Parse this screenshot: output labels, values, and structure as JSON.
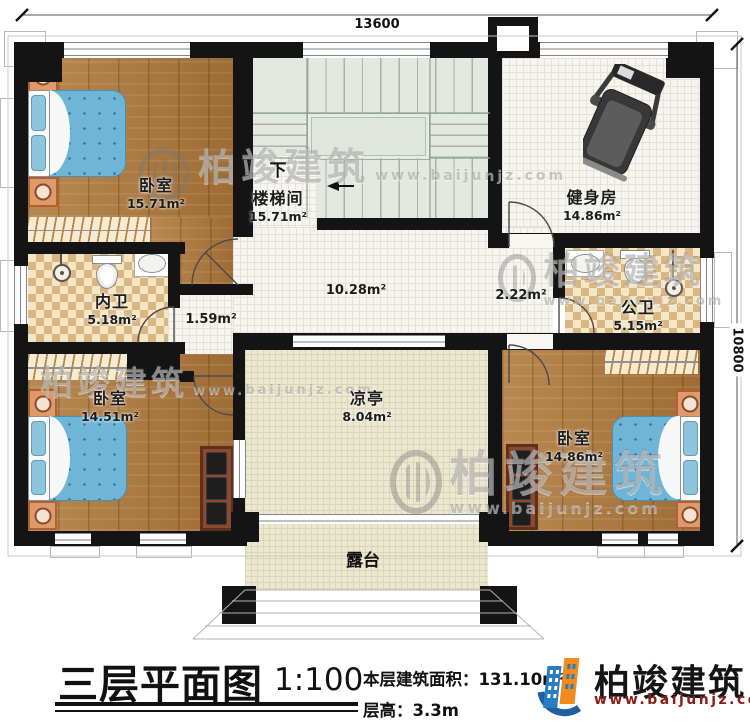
{
  "dimensions": {
    "top": "13600",
    "right": "10800"
  },
  "rooms": {
    "bedroom_tl": {
      "name": "卧室",
      "area": "15.71m²"
    },
    "stairwell": {
      "name": "楼梯间",
      "area": "15.71m²",
      "direction": "下"
    },
    "gym": {
      "name": "健身房",
      "area": "14.86m²"
    },
    "bath_inner": {
      "name": "内卫",
      "area": "5.18m²"
    },
    "bath_public": {
      "name": "公卫",
      "area": "5.15m²"
    },
    "bedroom_bl": {
      "name": "卧室",
      "area": "14.51m²"
    },
    "bedroom_br": {
      "name": "卧室",
      "area": "14.86m²"
    },
    "pavilion": {
      "name": "凉亭",
      "area": "8.04m²"
    },
    "terrace": {
      "name": "露台"
    },
    "hall": {
      "area": "10.28m²"
    },
    "nook": {
      "area": "1.59m²"
    },
    "corridor_right": {
      "area": "2.22m²"
    }
  },
  "titleblock": {
    "title": "三层平面图",
    "scale": "1:100",
    "area_line": "本层建筑面积：131.10m²",
    "height_line": "层高：3.3m"
  },
  "brand": {
    "name": "柏竣建筑",
    "website": "www.baijunjz.com"
  },
  "watermark": {
    "name": "柏竣建筑",
    "website": "www.baijunjz.com"
  },
  "colors": {
    "wall": "#141414",
    "wood_floor": "#b0783a",
    "bath_tile_dark": "#d9b682",
    "stair_floor": "#e3e8e1",
    "bed_blanket": "#6fb5d7",
    "logo_blue": "#2a7cc0",
    "logo_orange": "#f08b1e",
    "website_red": "#8a201a"
  }
}
